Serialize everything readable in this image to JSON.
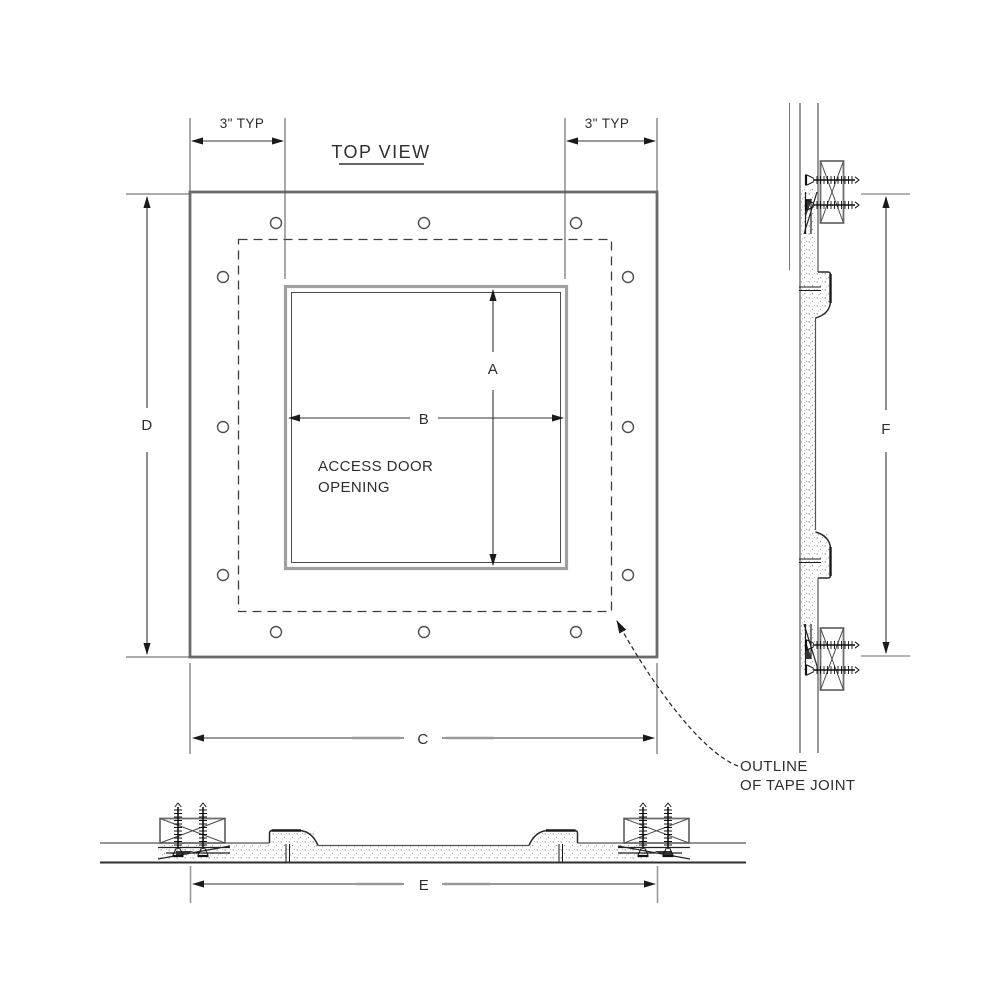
{
  "drawing": {
    "title": "TOP VIEW",
    "labels": {
      "typ_left": "3\" TYP",
      "typ_right": "3\" TYP",
      "dim_a": "A",
      "dim_b": "B",
      "dim_c": "C",
      "dim_d": "D",
      "dim_e": "E",
      "dim_f": "F",
      "opening_line1": "ACCESS DOOR",
      "opening_line2": "OPENING",
      "note_line1": "OUTLINE",
      "note_line2": "OF TAPE JOINT"
    },
    "colors": {
      "line_dark": "#2f2f2f",
      "line_medium": "#6b6b6b",
      "line_light": "#9a9a9a",
      "text": "#2e2e2e",
      "background": "#ffffff"
    }
  }
}
